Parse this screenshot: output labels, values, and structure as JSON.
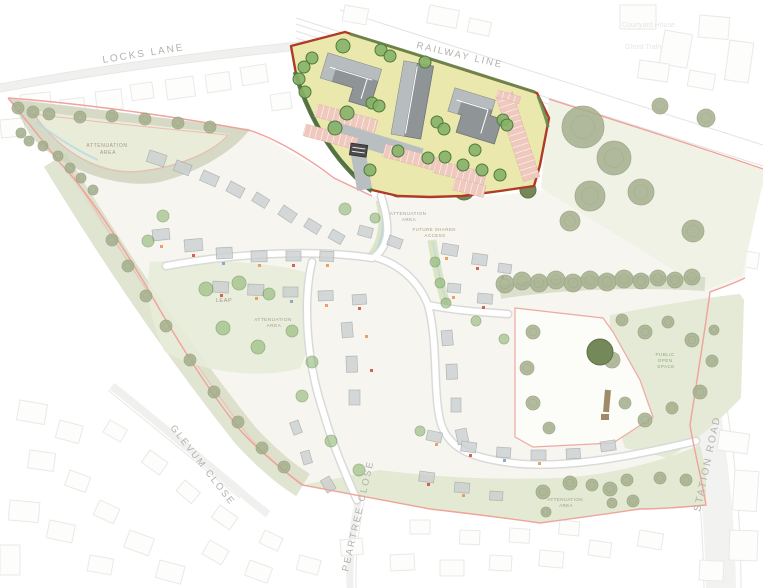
{
  "meta": {
    "title": "Residential development site masterplan"
  },
  "colors": {
    "site_boundary_pink": "#EF9F98",
    "phase_boundary_red": "#AF3B26",
    "employment_area_fill": "#EBE8AD",
    "building_gray_dark": "#8F9597",
    "building_gray_light": "#B7BCBE",
    "parking_salmon": "#EFC8BE",
    "internal_road_gray": "#B9BFC1",
    "tree_green": "#86B168",
    "hedge_green": "#4F7340",
    "olive_tree": "#A6B08E",
    "open_space_green": "#E4EAD5",
    "label_gray": "#B3B1AE",
    "background": "#FFFFFF"
  },
  "labels": {
    "locks_lane": "LOCKS LANE",
    "railway_line": "RAILWAY LINE",
    "courtyard_house": "Courtyard House",
    "ghost_train": "Ghost Train",
    "glevum_close": "GLEVUM CLOSE",
    "peartree_close": "PEARTREE CLOSE",
    "station_road": "STATION ROAD",
    "attenuation_line1": "ATTENUATION",
    "attenuation_line2": "AREA",
    "future_access_line1": "FUTURE SHARED",
    "future_access_line2": "ACCESS",
    "leap": "LEAP",
    "pos_line1": "PUBLIC",
    "pos_line2": "OPEN",
    "pos_line3": "SPACE"
  },
  "scene": {
    "context_buildings": [
      [
        20,
        95,
        30,
        22,
        -6
      ],
      [
        60,
        100,
        24,
        18,
        -6
      ],
      [
        95,
        92,
        26,
        20,
        -7
      ],
      [
        130,
        85,
        22,
        16,
        -8
      ],
      [
        165,
        80,
        28,
        20,
        -8
      ],
      [
        205,
        75,
        24,
        18,
        -8
      ],
      [
        240,
        68,
        26,
        18,
        -9
      ],
      [
        270,
        95,
        20,
        16,
        -8
      ],
      [
        55,
        130,
        22,
        16,
        -6
      ],
      [
        110,
        120,
        20,
        15,
        -7
      ],
      [
        0,
        120,
        24,
        18,
        -5
      ],
      [
        345,
        5,
        24,
        16,
        10
      ],
      [
        430,
        5,
        30,
        18,
        11
      ],
      [
        470,
        18,
        22,
        14,
        12
      ],
      [
        620,
        5,
        36,
        24,
        0
      ],
      [
        665,
        30,
        28,
        34,
        10
      ],
      [
        700,
        15,
        30,
        22,
        5
      ],
      [
        640,
        60,
        30,
        18,
        8
      ],
      [
        690,
        70,
        26,
        16,
        10
      ],
      [
        730,
        40,
        24,
        40,
        8
      ],
      [
        720,
        210,
        28,
        20,
        15
      ],
      [
        740,
        250,
        20,
        16,
        10
      ],
      [
        720,
        430,
        30,
        20,
        8
      ],
      [
        735,
        470,
        24,
        40,
        4
      ],
      [
        730,
        530,
        28,
        30,
        2
      ],
      [
        700,
        560,
        24,
        20,
        3
      ],
      [
        20,
        400,
        28,
        20,
        10
      ],
      [
        60,
        420,
        24,
        18,
        15
      ],
      [
        30,
        450,
        26,
        18,
        8
      ],
      [
        70,
        470,
        22,
        16,
        20
      ],
      [
        10,
        500,
        30,
        20,
        5
      ],
      [
        50,
        520,
        26,
        18,
        12
      ],
      [
        100,
        500,
        22,
        16,
        25
      ],
      [
        130,
        530,
        26,
        18,
        20
      ],
      [
        90,
        555,
        24,
        16,
        10
      ],
      [
        160,
        560,
        26,
        18,
        15
      ],
      [
        0,
        545,
        20,
        30,
        0
      ],
      [
        210,
        540,
        22,
        16,
        30
      ],
      [
        250,
        560,
        24,
        16,
        20
      ],
      [
        110,
        420,
        20,
        14,
        30
      ],
      [
        150,
        450,
        22,
        15,
        35
      ],
      [
        185,
        480,
        20,
        14,
        40
      ],
      [
        220,
        505,
        22,
        15,
        35
      ],
      [
        265,
        530,
        20,
        14,
        25
      ],
      [
        300,
        555,
        22,
        15,
        15
      ],
      [
        230,
        385,
        18,
        13,
        35
      ],
      [
        265,
        410,
        18,
        13,
        40
      ],
      [
        290,
        440,
        18,
        13,
        45
      ],
      [
        340,
        540,
        22,
        16,
        -5
      ],
      [
        390,
        555,
        24,
        16,
        -3
      ],
      [
        440,
        560,
        24,
        16,
        0
      ],
      [
        490,
        555,
        22,
        15,
        3
      ],
      [
        540,
        550,
        24,
        16,
        5
      ],
      [
        590,
        540,
        22,
        15,
        8
      ],
      [
        640,
        530,
        24,
        16,
        10
      ],
      [
        410,
        520,
        20,
        14,
        0
      ],
      [
        460,
        530,
        20,
        14,
        2
      ],
      [
        510,
        528,
        20,
        14,
        4
      ],
      [
        560,
        520,
        20,
        14,
        6
      ]
    ],
    "houses": [
      [
        150,
        150,
        18,
        12,
        18
      ],
      [
        177,
        160,
        16,
        11,
        20
      ],
      [
        204,
        170,
        17,
        11,
        24
      ],
      [
        231,
        181,
        16,
        11,
        28
      ],
      [
        257,
        192,
        15,
        10,
        32
      ],
      [
        284,
        205,
        16,
        11,
        34
      ],
      [
        309,
        218,
        15,
        10,
        32
      ],
      [
        333,
        229,
        14,
        10,
        30
      ],
      [
        152,
        230,
        17,
        11,
        -6
      ],
      [
        184,
        240,
        18,
        12,
        -5
      ],
      [
        216,
        248,
        16,
        11,
        -3
      ],
      [
        251,
        251,
        16,
        11,
        -1
      ],
      [
        286,
        251,
        15,
        10,
        0
      ],
      [
        320,
        251,
        14,
        10,
        2
      ],
      [
        213,
        281,
        16,
        11,
        4
      ],
      [
        248,
        284,
        16,
        11,
        2
      ],
      [
        283,
        287,
        15,
        10,
        0
      ],
      [
        318,
        291,
        15,
        10,
        -2
      ],
      [
        352,
        295,
        14,
        10,
        -4
      ],
      [
        352,
        322,
        15,
        11,
        85
      ],
      [
        357,
        356,
        16,
        11,
        88
      ],
      [
        360,
        390,
        15,
        11,
        90
      ],
      [
        452,
        330,
        15,
        11,
        85
      ],
      [
        457,
        364,
        15,
        11,
        88
      ],
      [
        461,
        398,
        14,
        10,
        90
      ],
      [
        466,
        428,
        15,
        11,
        78
      ],
      [
        443,
        243,
        16,
        11,
        10
      ],
      [
        473,
        253,
        15,
        11,
        8
      ],
      [
        499,
        263,
        13,
        9,
        8
      ],
      [
        448,
        283,
        13,
        9,
        5
      ],
      [
        478,
        293,
        15,
        10,
        5
      ],
      [
        428,
        430,
        15,
        10,
        12
      ],
      [
        462,
        441,
        15,
        10,
        8
      ],
      [
        497,
        447,
        14,
        10,
        4
      ],
      [
        531,
        450,
        15,
        10,
        0
      ],
      [
        566,
        449,
        14,
        10,
        -3
      ],
      [
        600,
        442,
        15,
        10,
        -8
      ],
      [
        420,
        471,
        15,
        10,
        8
      ],
      [
        455,
        482,
        15,
        10,
        5
      ],
      [
        490,
        491,
        13,
        9,
        3
      ],
      [
        298,
        420,
        13,
        9,
        70
      ],
      [
        309,
        450,
        13,
        9,
        74
      ],
      [
        329,
        476,
        14,
        10,
        60
      ],
      [
        360,
        225,
        14,
        10,
        15
      ],
      [
        390,
        235,
        14,
        10,
        20
      ]
    ],
    "door_dots": [
      [
        160,
        245,
        "#e8924f"
      ],
      [
        192,
        254,
        "#cf4a38"
      ],
      [
        222,
        262,
        "#7d9cc0"
      ],
      [
        258,
        264,
        "#e8924f"
      ],
      [
        292,
        264,
        "#cf4a38"
      ],
      [
        326,
        264,
        "#e8924f"
      ],
      [
        220,
        294,
        "#cf4a38"
      ],
      [
        255,
        297,
        "#e8924f"
      ],
      [
        290,
        300,
        "#7d9cc0"
      ],
      [
        325,
        304,
        "#e8924f"
      ],
      [
        358,
        307,
        "#cf4a38"
      ],
      [
        365,
        335,
        "#e8924f"
      ],
      [
        370,
        369,
        "#cf4a38"
      ],
      [
        445,
        257,
        "#e8924f"
      ],
      [
        476,
        267,
        "#cf4a38"
      ],
      [
        501,
        276,
        "#7d9cc0"
      ],
      [
        452,
        296,
        "#e8924f"
      ],
      [
        482,
        306,
        "#cf4a38"
      ],
      [
        435,
        443,
        "#e8924f"
      ],
      [
        469,
        454,
        "#cf4a38"
      ],
      [
        503,
        459,
        "#7d9cc0"
      ],
      [
        538,
        462,
        "#e8924f"
      ],
      [
        427,
        483,
        "#cf4a38"
      ],
      [
        462,
        494,
        "#e8924f"
      ]
    ],
    "trees_bright_faded": [
      [
        163,
        216,
        6
      ],
      [
        148,
        241,
        6
      ],
      [
        206,
        289,
        7
      ],
      [
        239,
        283,
        7
      ],
      [
        269,
        294,
        6
      ],
      [
        223,
        328,
        7
      ],
      [
        258,
        347,
        7
      ],
      [
        292,
        331,
        6
      ],
      [
        312,
        362,
        6
      ],
      [
        345,
        209,
        6
      ],
      [
        435,
        262,
        5
      ],
      [
        440,
        283,
        5
      ],
      [
        446,
        303,
        5
      ],
      [
        302,
        396,
        6
      ],
      [
        331,
        441,
        6
      ],
      [
        359,
        470,
        6
      ],
      [
        476,
        321,
        5
      ],
      [
        504,
        339,
        5
      ],
      [
        420,
        431,
        5
      ],
      [
        375,
        218,
        5
      ]
    ],
    "trees_bright_yellow": [
      [
        312,
        58,
        6
      ],
      [
        304,
        67,
        6
      ],
      [
        299,
        79,
        6
      ],
      [
        343,
        46,
        7
      ],
      [
        381,
        50,
        6
      ],
      [
        390,
        56,
        6
      ],
      [
        425,
        62,
        6
      ],
      [
        372,
        103,
        6
      ],
      [
        379,
        106,
        6
      ],
      [
        347,
        113,
        7
      ],
      [
        335,
        128,
        7
      ],
      [
        437,
        122,
        6
      ],
      [
        444,
        129,
        6
      ],
      [
        398,
        151,
        6
      ],
      [
        428,
        158,
        6
      ],
      [
        445,
        157,
        6
      ],
      [
        463,
        165,
        6
      ],
      [
        482,
        170,
        6
      ],
      [
        500,
        175,
        6
      ],
      [
        475,
        150,
        6
      ],
      [
        503,
        120,
        6
      ],
      [
        507,
        125,
        6
      ],
      [
        370,
        170,
        6
      ],
      [
        305,
        92,
        6
      ]
    ],
    "trees_olive": [
      [
        583,
        127,
        21
      ],
      [
        614,
        158,
        17
      ],
      [
        590,
        196,
        15
      ],
      [
        641,
        192,
        13
      ],
      [
        570,
        221,
        10
      ],
      [
        693,
        231,
        11
      ],
      [
        706,
        118,
        9
      ],
      [
        660,
        106,
        8
      ],
      [
        505,
        284,
        9
      ],
      [
        522,
        281,
        9
      ],
      [
        539,
        283,
        9
      ],
      [
        556,
        280,
        9
      ],
      [
        573,
        283,
        9
      ],
      [
        590,
        280,
        9
      ],
      [
        607,
        282,
        9
      ],
      [
        624,
        279,
        9
      ],
      [
        641,
        281,
        8
      ],
      [
        658,
        278,
        8
      ],
      [
        675,
        280,
        8
      ],
      [
        692,
        277,
        8
      ],
      [
        622,
        320,
        6
      ],
      [
        645,
        332,
        7
      ],
      [
        668,
        322,
        6
      ],
      [
        692,
        340,
        7
      ],
      [
        712,
        361,
        6
      ],
      [
        700,
        392,
        7
      ],
      [
        672,
        408,
        6
      ],
      [
        645,
        420,
        7
      ],
      [
        625,
        403,
        6
      ],
      [
        714,
        330,
        5
      ],
      [
        533,
        332,
        7
      ],
      [
        527,
        368,
        7
      ],
      [
        533,
        403,
        7
      ],
      [
        549,
        428,
        6
      ],
      [
        612,
        360,
        8
      ],
      [
        18,
        108,
        6
      ],
      [
        33,
        112,
        6
      ],
      [
        49,
        114,
        6
      ],
      [
        80,
        117,
        6
      ],
      [
        112,
        116,
        6
      ],
      [
        145,
        119,
        6
      ],
      [
        178,
        123,
        6
      ],
      [
        210,
        127,
        6
      ],
      [
        21,
        133,
        5
      ],
      [
        29,
        141,
        5
      ],
      [
        43,
        146,
        5
      ],
      [
        58,
        156,
        5
      ],
      [
        70,
        168,
        5
      ],
      [
        81,
        178,
        5
      ],
      [
        93,
        190,
        5
      ],
      [
        112,
        240,
        6
      ],
      [
        128,
        266,
        6
      ],
      [
        146,
        296,
        6
      ],
      [
        166,
        326,
        6
      ],
      [
        190,
        360,
        6
      ],
      [
        214,
        392,
        6
      ],
      [
        238,
        422,
        6
      ],
      [
        262,
        448,
        6
      ],
      [
        284,
        467,
        6
      ],
      [
        543,
        492,
        7
      ],
      [
        570,
        483,
        7
      ],
      [
        592,
        485,
        6
      ],
      [
        610,
        489,
        7
      ],
      [
        627,
        480,
        6
      ],
      [
        633,
        501,
        6
      ],
      [
        612,
        503,
        5
      ],
      [
        546,
        512,
        5
      ],
      [
        660,
        478,
        6
      ],
      [
        686,
        480,
        6
      ]
    ],
    "trees_dark": [
      [
        398,
        187,
        10
      ],
      [
        464,
        190,
        10
      ],
      [
        600,
        352,
        13
      ],
      [
        528,
        190,
        8
      ]
    ],
    "parking_rows": [
      [
        318,
        104,
        62,
        13,
        15
      ],
      [
        306,
        124,
        54,
        12,
        15
      ],
      [
        386,
        144,
        56,
        13,
        15
      ],
      [
        436,
        160,
        52,
        13,
        14
      ],
      [
        512,
        91,
        90,
        17,
        72
      ],
      [
        455,
        178,
        32,
        12,
        14
      ],
      [
        498,
        90,
        24,
        7,
        17
      ]
    ]
  }
}
